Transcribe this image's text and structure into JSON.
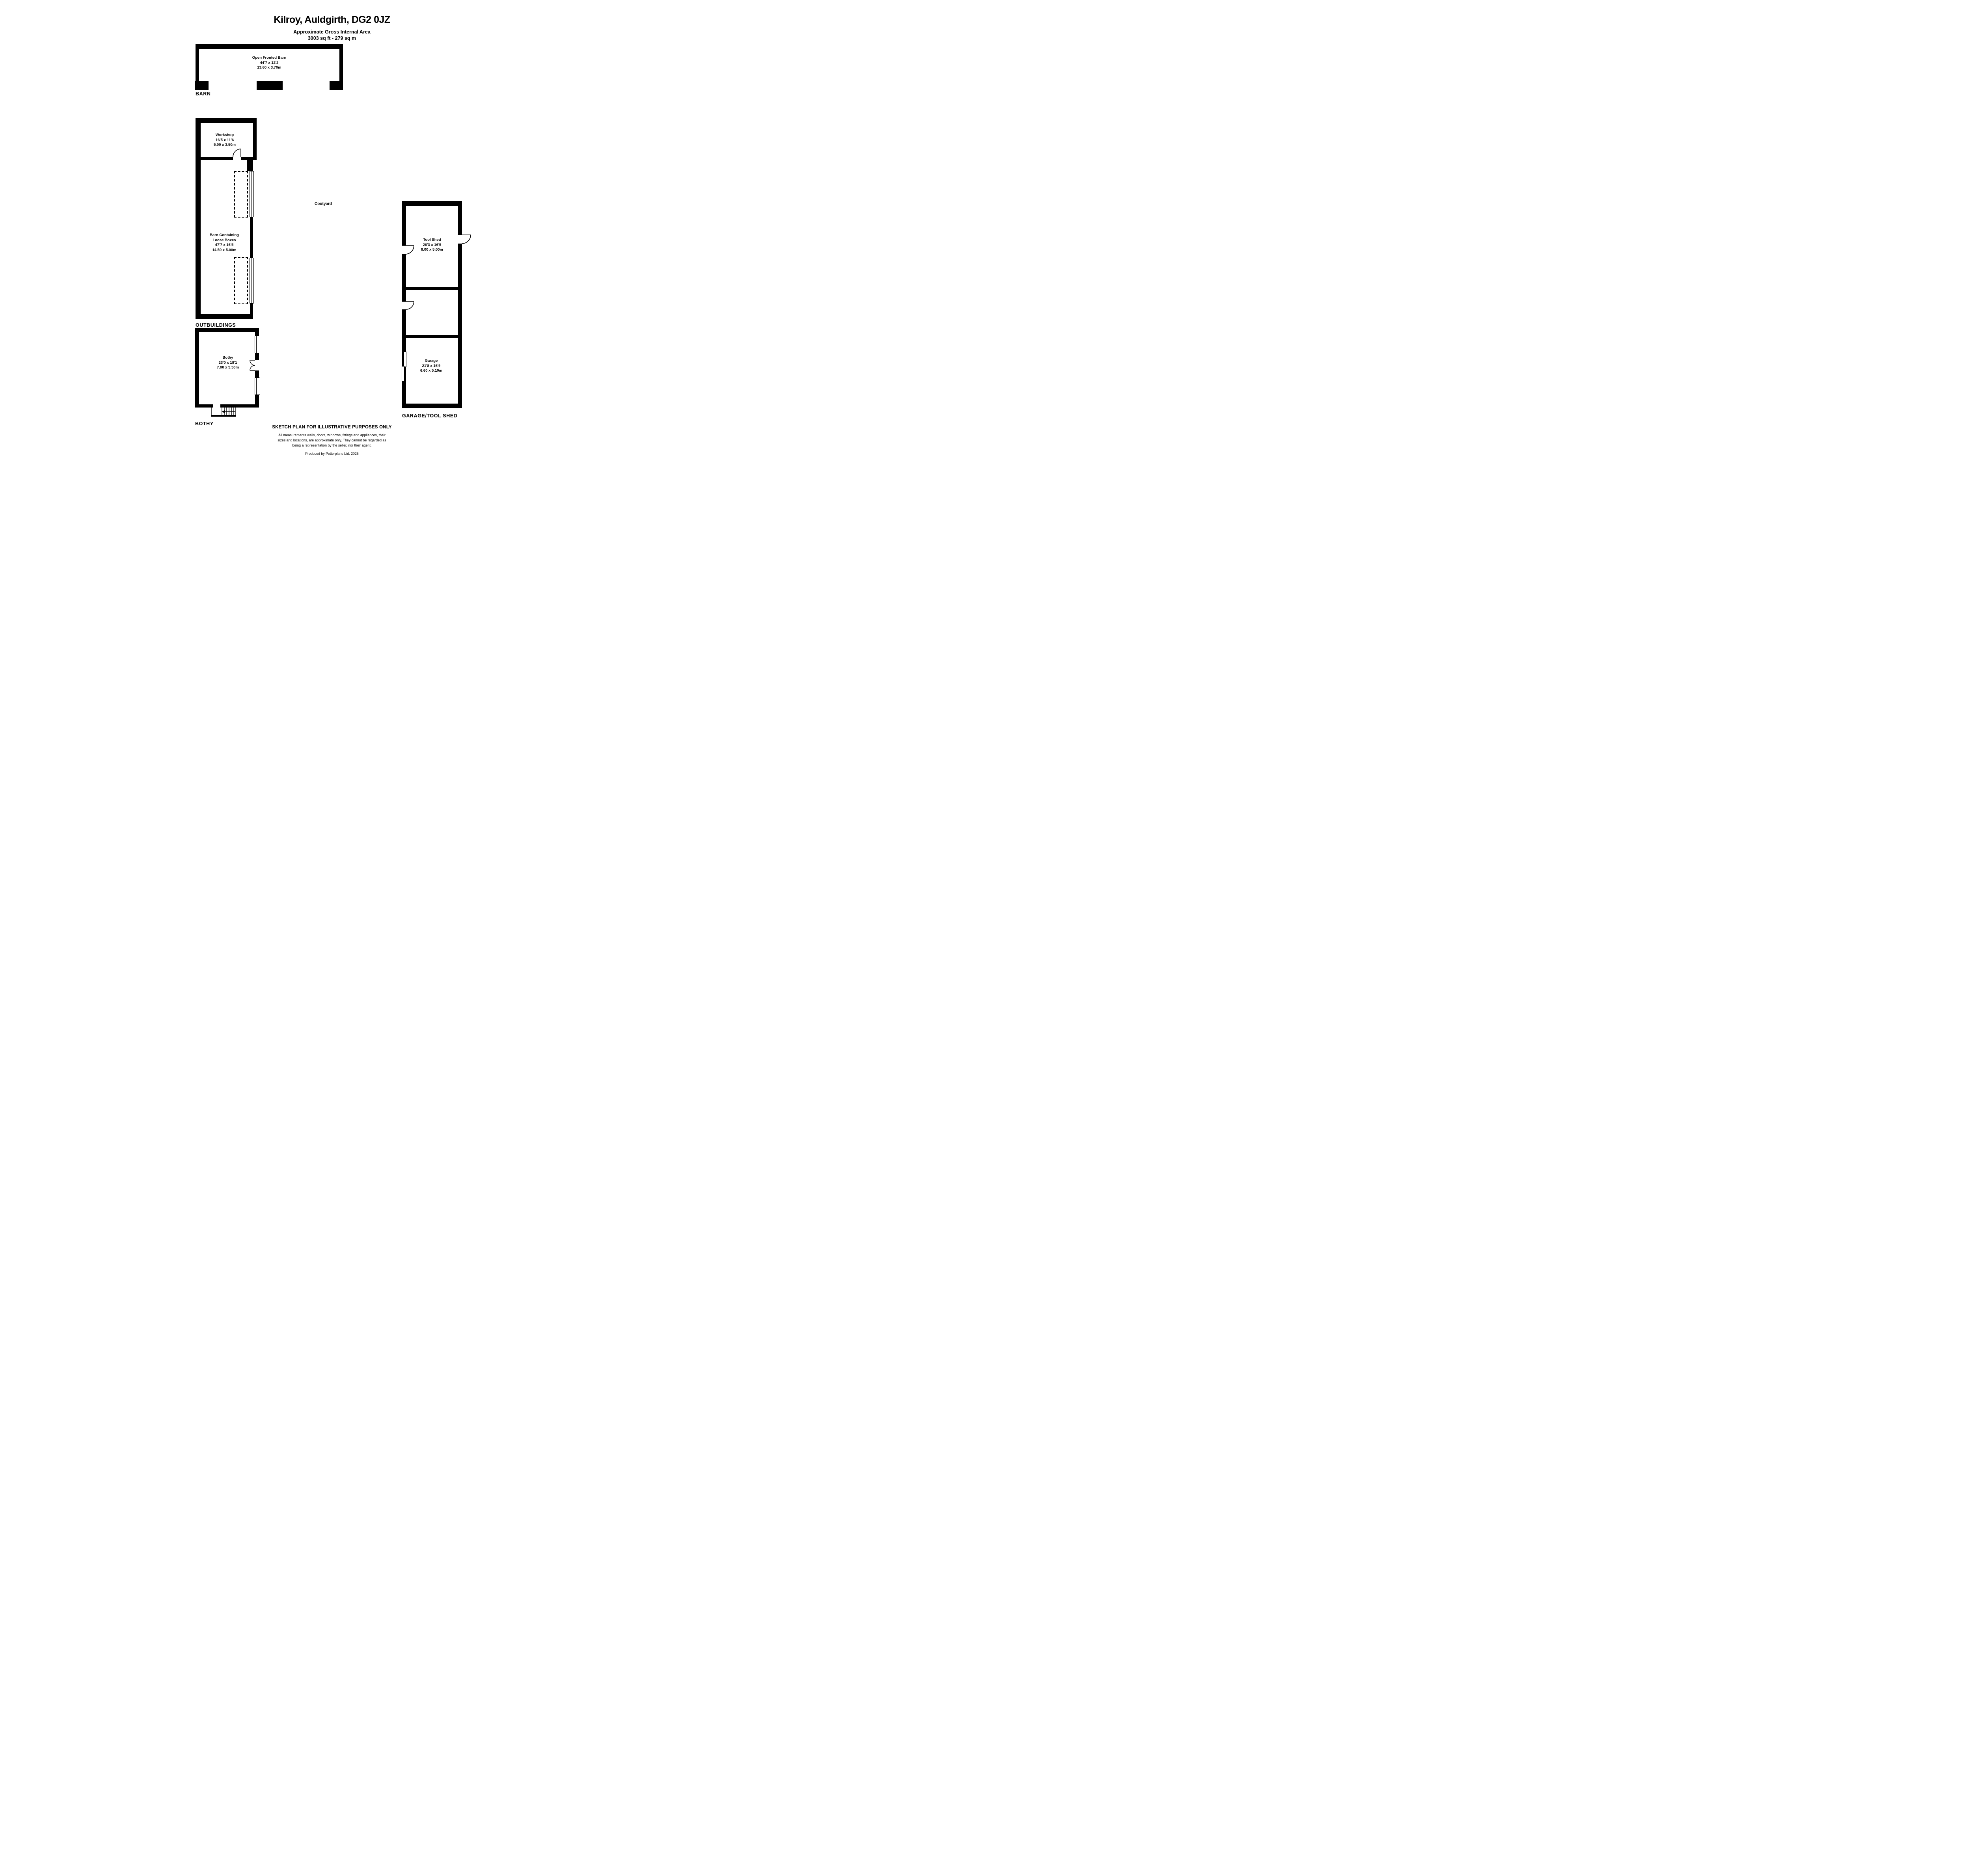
{
  "title": {
    "line1": "Kilroy, Auldgirth, DG2 0JZ",
    "line2": "Approximate Gross Internal Area",
    "line3": "3003 sq ft - 279 sq m"
  },
  "labels": {
    "barn": "BARN",
    "outbuildings": "OUTBUILDINGS",
    "bothy": "BOTHY",
    "garage_tool_shed": "GARAGE/TOOL SHED",
    "courtyard": "Coutyard"
  },
  "rooms": {
    "open_fronted_barn": {
      "name": "Open Fronted Barn",
      "imperial": "44'7 x 12'2",
      "metric": "13.60 x 3.70m"
    },
    "workshop": {
      "name": "Workshop",
      "imperial": "16'5 x 11'6",
      "metric": "5.00 x 3.50m"
    },
    "loose_boxes": {
      "name1": "Barn Containing",
      "name2": "Loose Boxes",
      "imperial": "47'7 x 16'5",
      "metric": "14.50 x 5.00m"
    },
    "bothy": {
      "name": "Bothy",
      "imperial": "23'0 x 18'1",
      "metric": "7.00 x 5.50m"
    },
    "tool_shed": {
      "name": "Tool Shed",
      "imperial": "26'3 x 16'5",
      "metric": "8.00 x 5.00m"
    },
    "garage": {
      "name": "Garage",
      "imperial": "21'8 x 16'9",
      "metric": "6.60 x 5.10m"
    }
  },
  "footer": {
    "heading": "SKETCH PLAN FOR ILLUSTRATIVE PURPOSES ONLY",
    "disclaimer1": "All measurements walls, doors, windows, fittings and appliances, their",
    "disclaimer2": "sizes and locations, are approximate only. They cannot be regarded as",
    "disclaimer3": "being a representation by the seller, nor their agent.",
    "credit": "Produced by Potterplans Ltd. 2025"
  },
  "colors": {
    "wall": "#000000",
    "background": "#ffffff",
    "text": "#000000"
  }
}
